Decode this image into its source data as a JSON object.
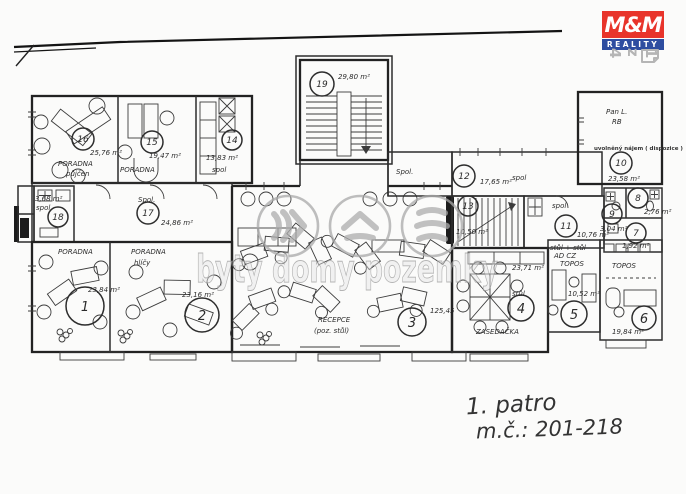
{
  "brand": {
    "name": "M&M",
    "tagline": "REALITY",
    "red": "#e8342b",
    "blue": "#2e4da0"
  },
  "page_indicator": {
    "label": "1 z 4",
    "color": "#b5b5b5"
  },
  "watermark": {
    "text": "byty domy pozemky",
    "icons": [
      "double-chevron-right-icon",
      "roof-chevron-icon",
      "waves-icon"
    ],
    "color": "#a9a9a9"
  },
  "notes": {
    "floor": "1. patro",
    "room_range": "m.č.: 201-218"
  },
  "plan": {
    "corridor_label": "Spol.",
    "rooms": {
      "r1": {
        "number": "1",
        "area": "23,84 m²",
        "label": "PORADNA"
      },
      "r2": {
        "number": "2",
        "area": "23,16 m²",
        "label": "PORADNA",
        "label2": "hlíčy"
      },
      "r3": {
        "number": "3",
        "area": "125,45",
        "label": "RECEPCE",
        "label2": "(poz. stůl)"
      },
      "r4": {
        "number": "4",
        "area": "23,71 m²",
        "label": "ZASEDAČKA",
        "label2": "stůl"
      },
      "r5": {
        "number": "5",
        "area": "10,52 m²",
        "label": "stůl + stůl",
        "label2": "AD CZ",
        "label3": "TOPOS"
      },
      "r6": {
        "number": "6",
        "area": "19,84 m²",
        "label": "TOPOS"
      },
      "r7": {
        "number": "7",
        "area": "1,92 m²"
      },
      "r8": {
        "number": "8",
        "area": "2,76 m²"
      },
      "r9": {
        "number": "9",
        "area": "3,04 m²"
      },
      "r10": {
        "number": "10",
        "area": "23,58 m²",
        "note_hand1": "Pan L.",
        "note_hand2": "RB",
        "note_print": "uvolněný nájem ( dispozice )"
      },
      "r11": {
        "number": "11",
        "area": "10,76 m²",
        "label": "spol"
      },
      "r12": {
        "number": "12",
        "area": "17,65 m²",
        "label": "spol"
      },
      "r13": {
        "number": "13",
        "area": "10,50 m²"
      },
      "r14": {
        "number": "14",
        "area": "13,83 m²",
        "label": "spol"
      },
      "r15": {
        "number": "15",
        "area": "19,47 m²",
        "label": "PORADNA"
      },
      "r16": {
        "number": "16",
        "area": "25,76 m²",
        "label": "PORADNA",
        "label2": "půjčen"
      },
      "r17": {
        "number": "17",
        "area": "24,86 m²",
        "label": "Spol."
      },
      "r18": {
        "number": "18",
        "area": "3,68 m²",
        "label": "spol"
      },
      "r19": {
        "number": "19",
        "area": "29,80 m²"
      }
    }
  }
}
